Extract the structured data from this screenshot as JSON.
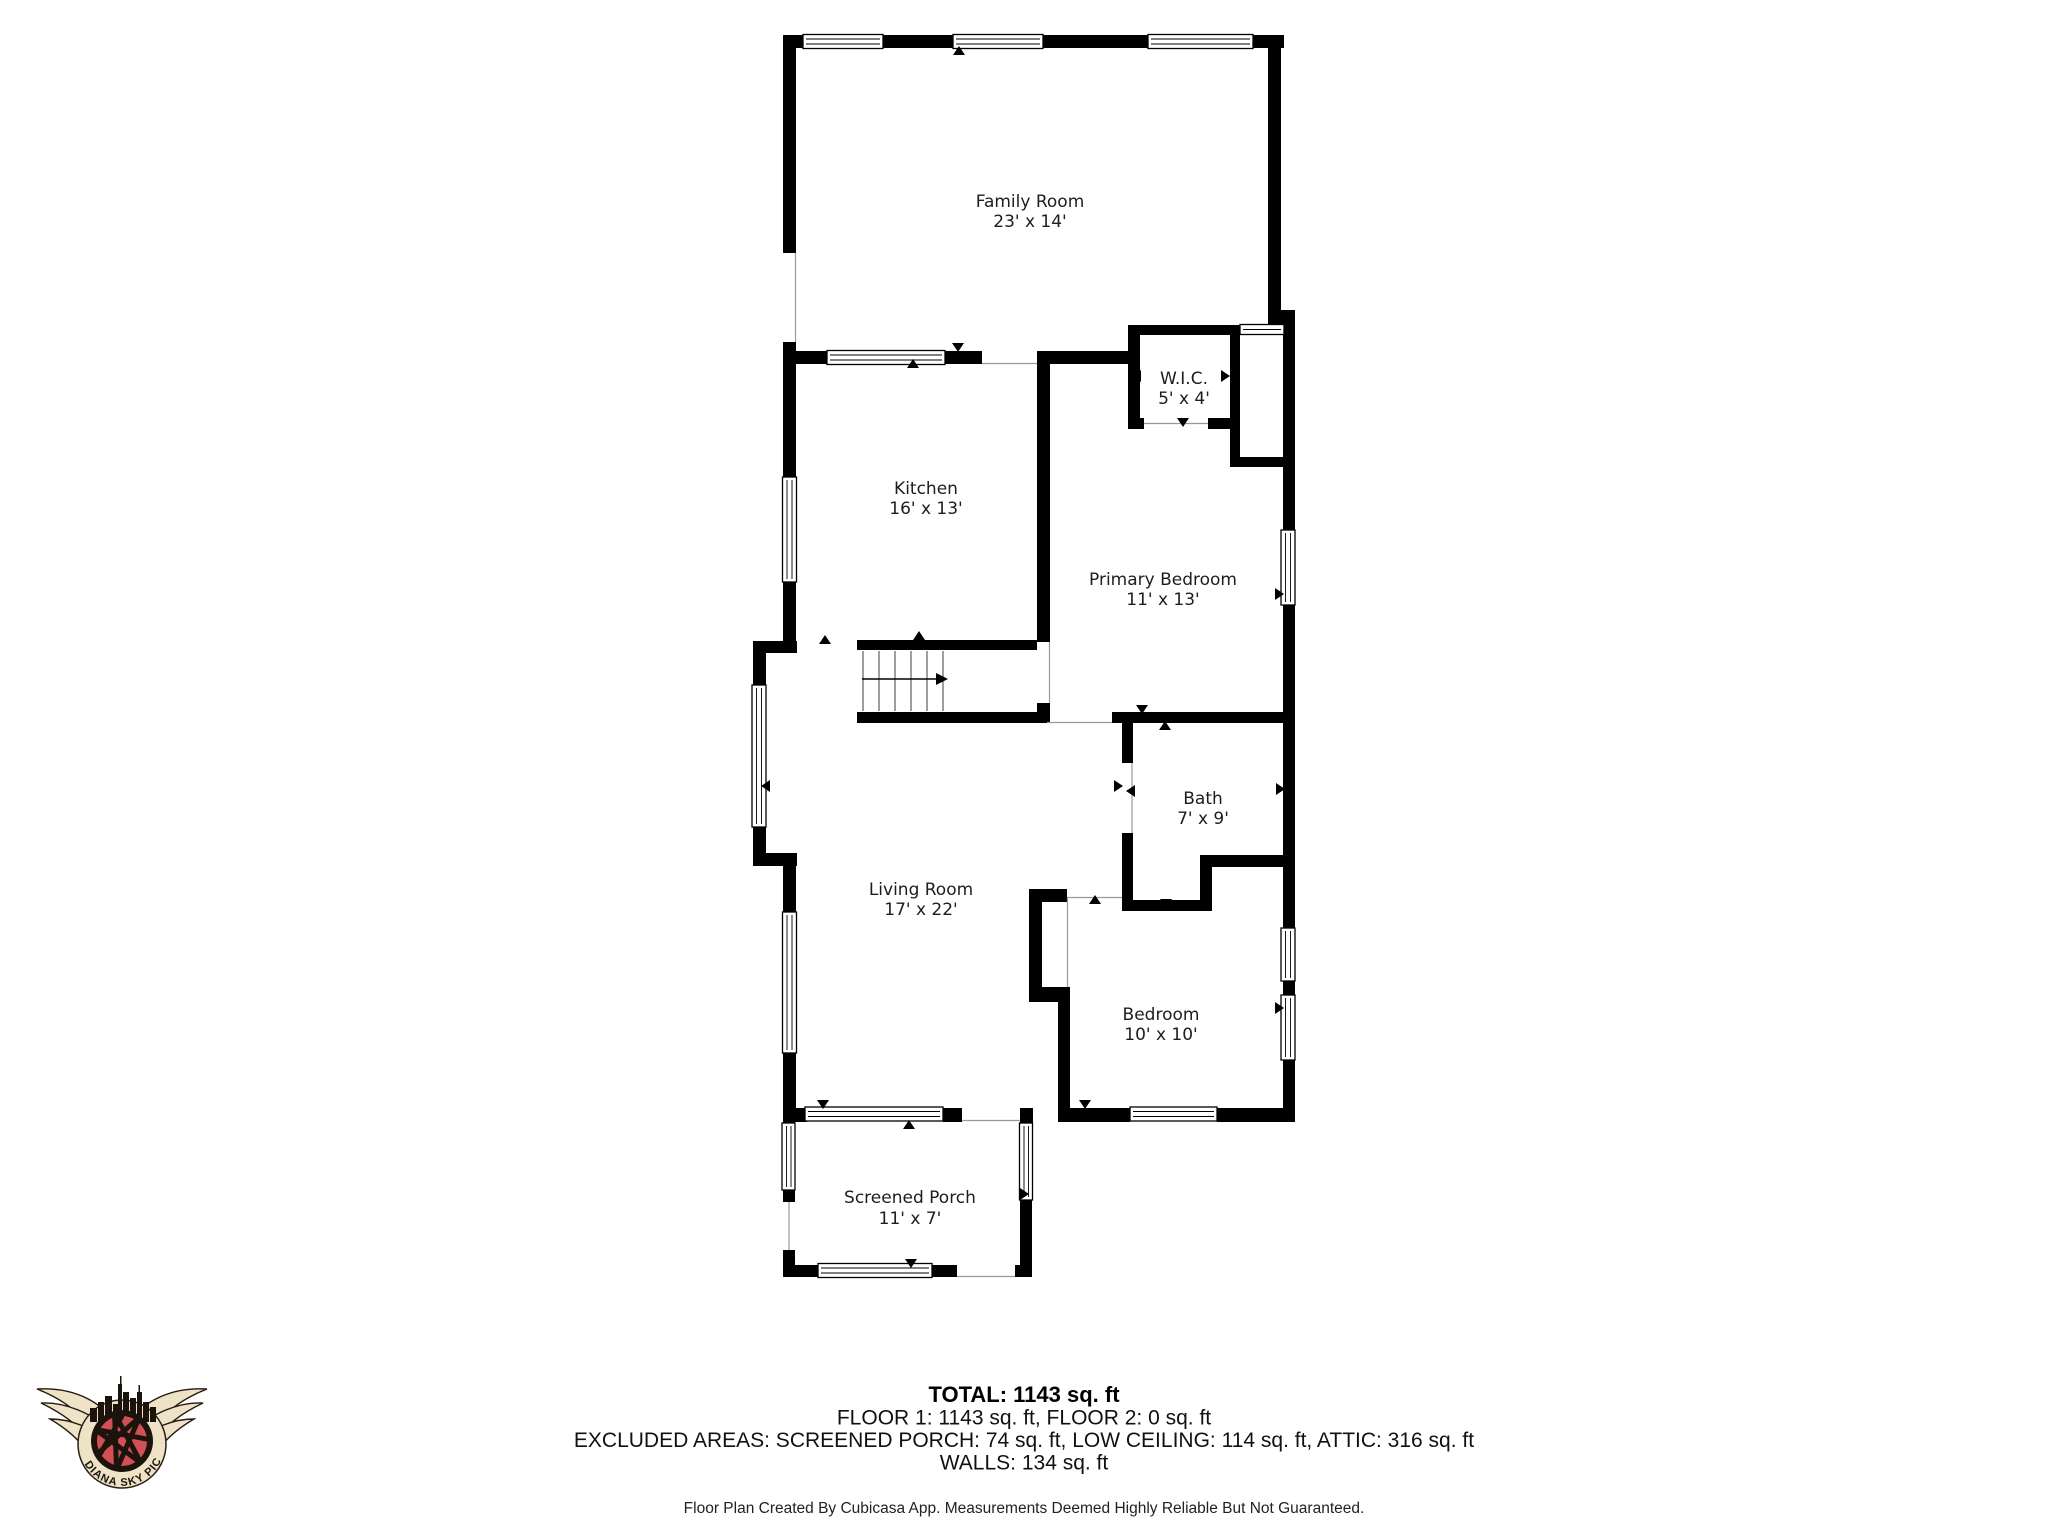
{
  "floorplan": {
    "rooms": [
      {
        "id": "family-room",
        "name": "Family Room",
        "dims": "23' x 14'"
      },
      {
        "id": "kitchen",
        "name": "Kitchen",
        "dims": "16' x 13'"
      },
      {
        "id": "wic",
        "name": "W.I.C.",
        "dims": "5' x 4'"
      },
      {
        "id": "primary-bedroom",
        "name": "Primary Bedroom",
        "dims": "11' x 13'"
      },
      {
        "id": "bath",
        "name": "Bath",
        "dims": "7' x 9'"
      },
      {
        "id": "living-room",
        "name": "Living Room",
        "dims": "17' x 22'"
      },
      {
        "id": "bedroom",
        "name": "Bedroom",
        "dims": "10' x 10'"
      },
      {
        "id": "screened-porch",
        "name": "Screened Porch",
        "dims": "11' x 7'"
      }
    ]
  },
  "summary": {
    "total": "TOTAL: 1143 sq. ft",
    "floors": "FLOOR 1: 1143 sq. ft, FLOOR 2: 0 sq. ft",
    "excluded_areas": "EXCLUDED AREAS: SCREENED PORCH: 74 sq. ft, LOW CEILING: 114 sq. ft, ATTIC: 316 sq. ft",
    "walls": "WALLS: 134 sq. ft"
  },
  "footer": {
    "disclaimer": "Floor Plan Created By Cubicasa App. Measurements Deemed Highly Reliable But Not Guaranteed."
  },
  "logo": {
    "brand": "INDIANA SKY PICS"
  },
  "colors": {
    "wall": "#000000",
    "background": "#ffffff",
    "label_text": "#1d1d1d",
    "logo_red": "#d05056",
    "logo_cream": "#eee3c6",
    "logo_dark": "#1c140c"
  }
}
